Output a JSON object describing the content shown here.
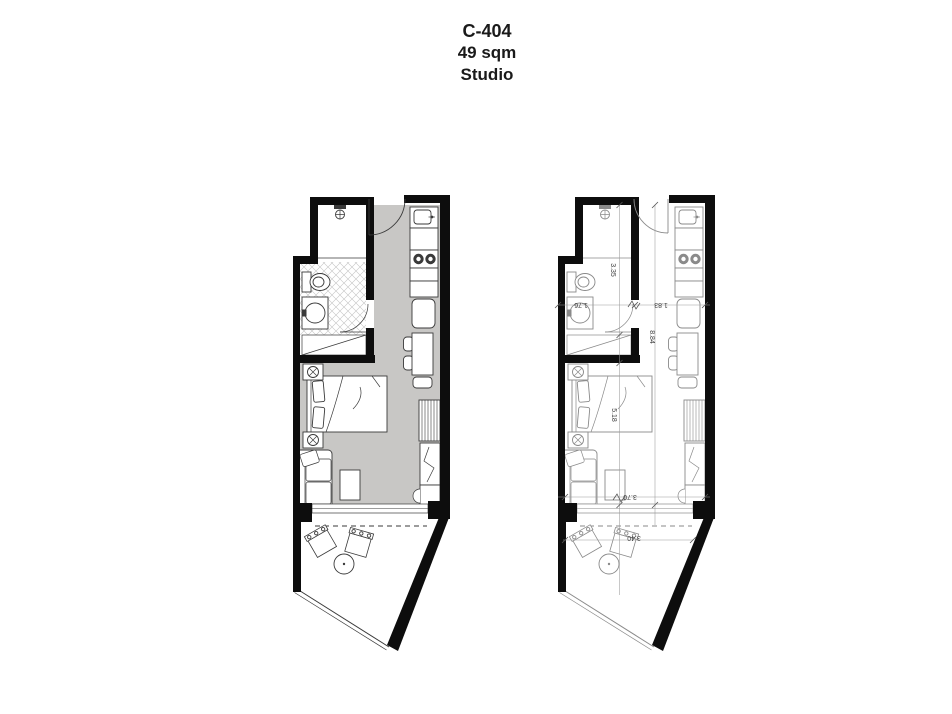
{
  "title": {
    "unit": "C-404",
    "area": "49 sqm",
    "type": "Studio"
  },
  "colors": {
    "background": "#ffffff",
    "wall": "#0d0d0d",
    "floor_gray": "#c8c7c5",
    "tile_line": "#c4c4c4",
    "furniture_dark": "#3a3a3a",
    "furniture_light": "#8a8a8a",
    "dimension_line": "#9a9a9a",
    "title_text": "#1a1a1a"
  },
  "left_plan": {
    "rooms": [
      "shower",
      "bathroom",
      "closet",
      "entry",
      "kitchen",
      "living-sleeping-area",
      "balcony"
    ],
    "furniture_icons": [
      "shower-head",
      "toilet",
      "washbasin",
      "kitchen-sink",
      "stove",
      "fridge",
      "dining-table",
      "dining-chairs",
      "double-bed",
      "nightstand-lamps",
      "wardrobe",
      "tv-unit",
      "sofa",
      "coffee-table",
      "sliding-door",
      "balcony-chairs",
      "balcony-table"
    ]
  },
  "right_plan": {
    "dimensions": {
      "bathroom_length": "3.35",
      "bathroom_width": "1.76",
      "kitchen_width": "1.83",
      "total_length": "8.84",
      "living_length": "5.18",
      "living_width": "3.70",
      "balcony_width": "3.40"
    }
  }
}
